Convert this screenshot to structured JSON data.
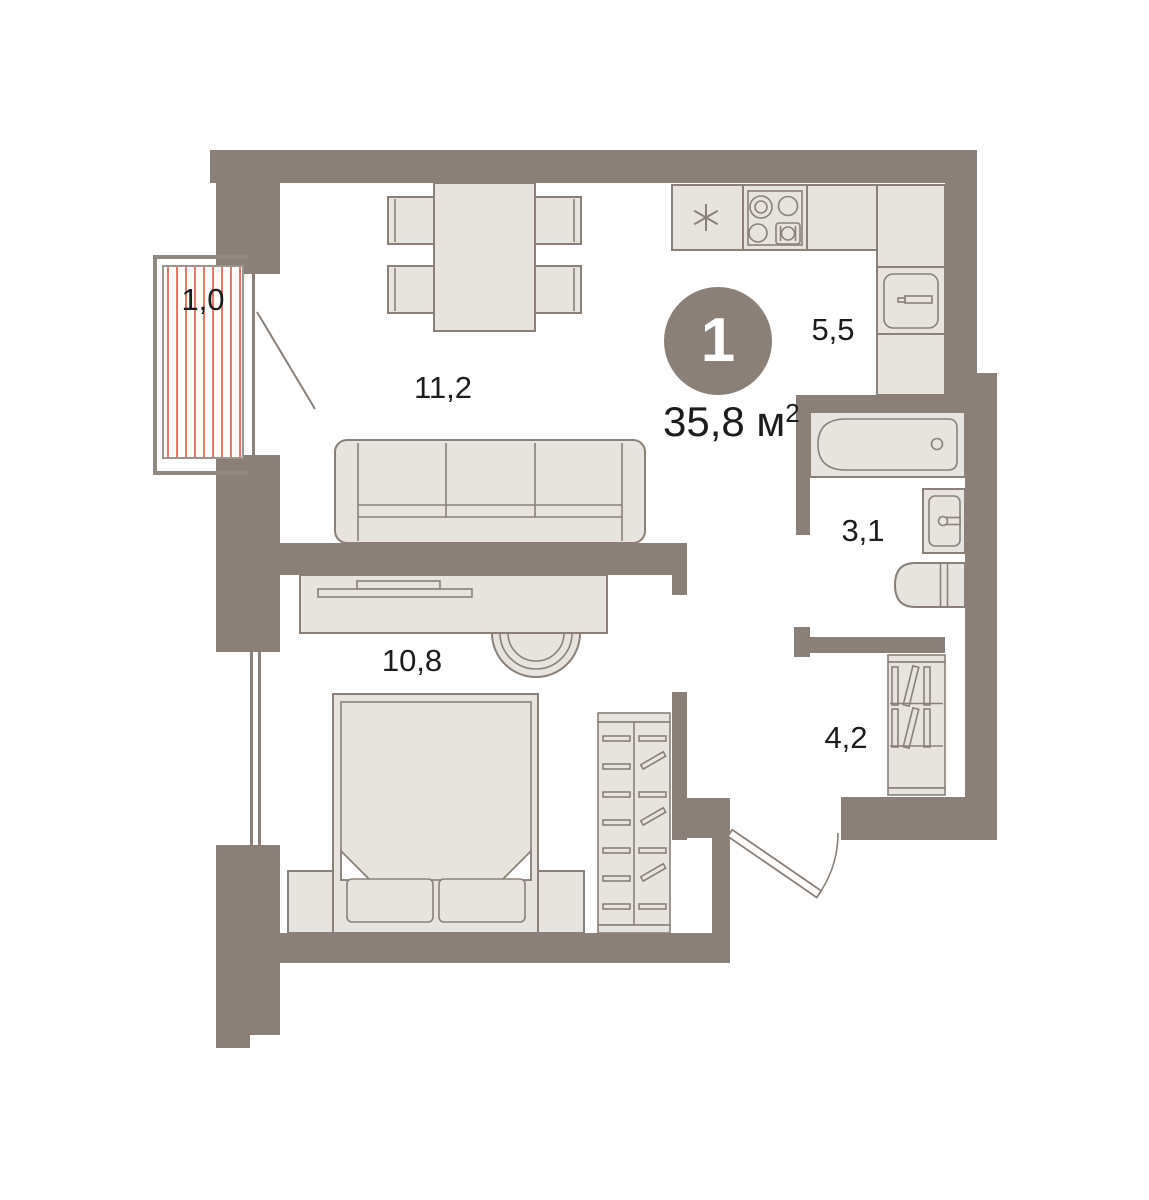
{
  "floorplan": {
    "rooms_badge": "1",
    "total_area": {
      "value": "35,8",
      "unit": "м",
      "sup": "2"
    },
    "room_labels": [
      {
        "id": "balcony",
        "area": "1,0"
      },
      {
        "id": "living-room",
        "area": "11,2"
      },
      {
        "id": "kitchen",
        "area": "5,5"
      },
      {
        "id": "bathroom",
        "area": "3,1"
      },
      {
        "id": "bedroom",
        "area": "10,8"
      },
      {
        "id": "hallway",
        "area": "4,2"
      }
    ]
  },
  "icons": {
    "asterisk": "kitchen asterisk symbol",
    "stove": "4-burner cooktop",
    "sink": "sink with faucet",
    "bathtub": "bathtub with drain",
    "washer": "washing machine",
    "door_swing": "door swing arc"
  },
  "colors": {
    "wall": "#8a8078",
    "line": "#8a8078",
    "furn": "#e7e4df",
    "railing": "#8f8982",
    "hatch": "#e0573e",
    "text": "#1c1c1c",
    "badge_fill": "#8a8078",
    "badge_text": "#ffffff",
    "bg": "#ffffff"
  }
}
